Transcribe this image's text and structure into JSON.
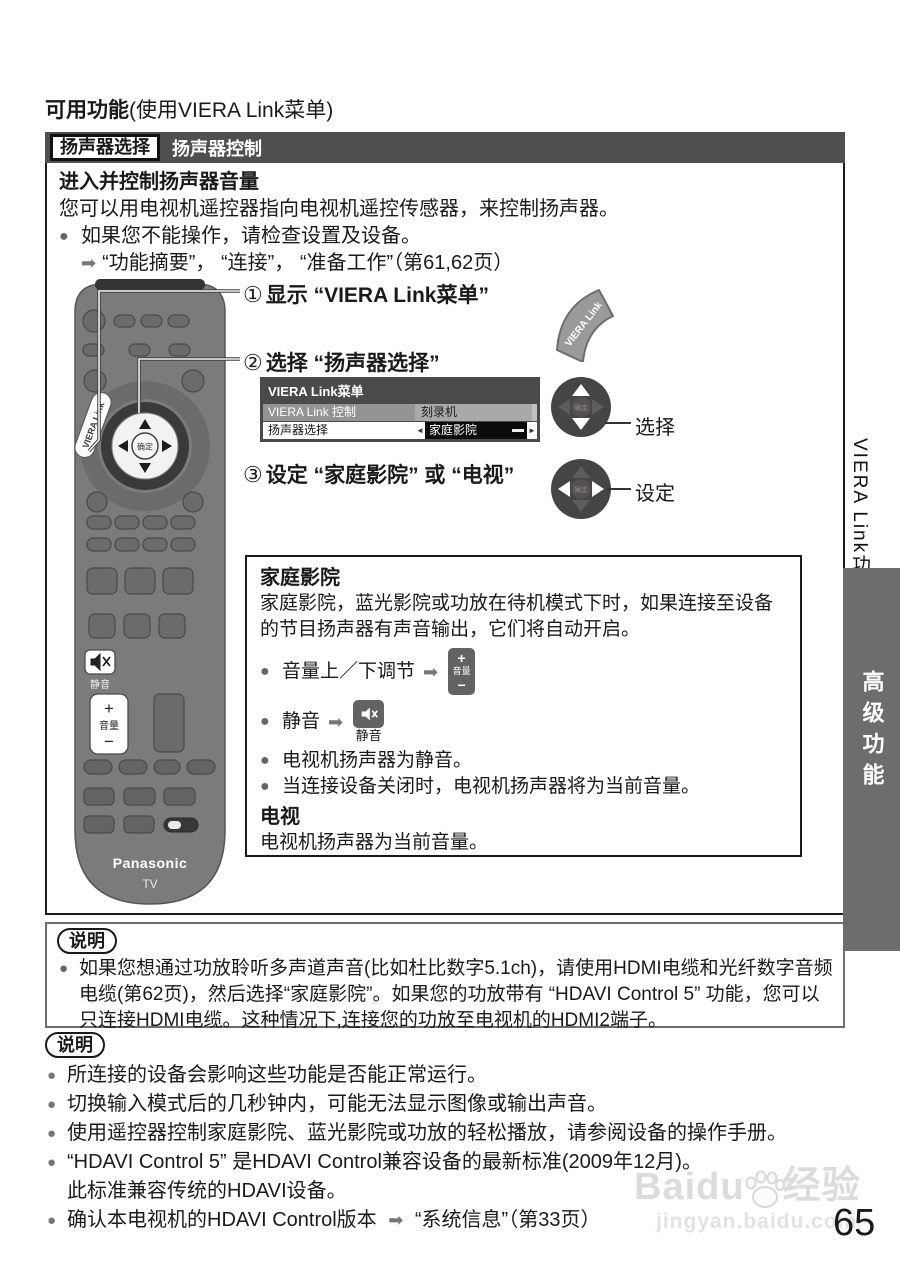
{
  "heading": {
    "strong": "可用功能",
    "normal": "(使用VIERA Link菜单)"
  },
  "section": {
    "tag": "扬声器选择",
    "title": "扬声器控制"
  },
  "intro": {
    "title": "进入并控制扬声器音量",
    "line": "您可以用电视机遥控器指向电视机遥控传感器，来控制扬声器。",
    "bullet": "如果您不能操作，请检查设置及设备。",
    "ref": "“功能摘要”， “连接”， “准备工作”（第61,62页）"
  },
  "steps": {
    "s1": {
      "num": "①",
      "text": "显示 “VIERA Link菜单”"
    },
    "s2": {
      "num": "②",
      "text": "选择 “扬声器选择”"
    },
    "s3": {
      "num": "③",
      "text": "设定 “家庭影院” 或 “电视”"
    }
  },
  "menu": {
    "title": "VIERA Link菜单",
    "rows": [
      {
        "label": "VIERA Link 控制",
        "value": "刻录机"
      },
      {
        "label": "扬声器选择",
        "value": "家庭影院"
      }
    ],
    "left_arrow": "◄",
    "right_arrow": "►"
  },
  "dpad": {
    "ok": "确定",
    "select": "选择",
    "set": "设定"
  },
  "ht": {
    "title": "家庭影院",
    "desc": "家庭影院，蓝光影院或功放在待机模式下时，如果连接至设备的节目扬声器有声音输出，它们将自动开启。",
    "vol_text": "音量上／下调节",
    "mute_text": "静音",
    "b1": "电视机扬声器为静音。",
    "b2": "当连接设备关闭时，电视机扬声器将为当前音量。",
    "tv_title": "电视",
    "tv_desc": "电视机扬声器为当前音量。"
  },
  "vol_btn": {
    "plus": "+",
    "label": "音量",
    "minus": "−"
  },
  "mute_btn": {
    "label": "静音"
  },
  "note1": {
    "label": "说明",
    "text": "如果您想通过功放聆听多声道声音(比如杜比数字5.1ch)，请使用HDMI电缆和光纤数字音频电缆(第62页)，然后选择“家庭影院”。如果您的功放带有 “HDAVI Control 5” 功能，您可以只连接HDMI电缆。这种情况下,连接您的功放至电视机的HDMI2端子。"
  },
  "note2": {
    "label": "说明",
    "bullets": [
      "所连接的设备会影响这些功能是否能正常运行。",
      "切换输入模式后的几秒钟内，可能无法显示图像或输出声音。",
      "使用遥控器控制家庭影院、蓝光影院或功放的轻松播放，请参阅设备的操作手册。",
      "“HDAVI Control 5” 是HDAVI Control兼容设备的最新标准(2009年12月)。"
    ],
    "cont": "此标准兼容传统的HDAVI设备。",
    "last": {
      "text": "确认本电视机的HDAVI Control版本",
      "ref": "“系统信息”（第33页）"
    }
  },
  "sidebar": {
    "top": "VIERA Link功能",
    "tab": "高级功能"
  },
  "remote": {
    "viera_link": "VIERA Link",
    "ok": "确定",
    "mute": "静音",
    "vol_plus": "+",
    "vol_label": "音量",
    "vol_minus": "−",
    "brand": "Panasonic",
    "tv": "TV"
  },
  "watermark": {
    "brand": "Baidu",
    "suffix": "经验",
    "url": "jingyan.baidu.com"
  },
  "page_number": "65",
  "colors": {
    "bar": "#4f4f4f",
    "tab": "#6d6d6d",
    "remote_body": "#7b7b7b",
    "menu_dark": "#4a4a4a"
  }
}
